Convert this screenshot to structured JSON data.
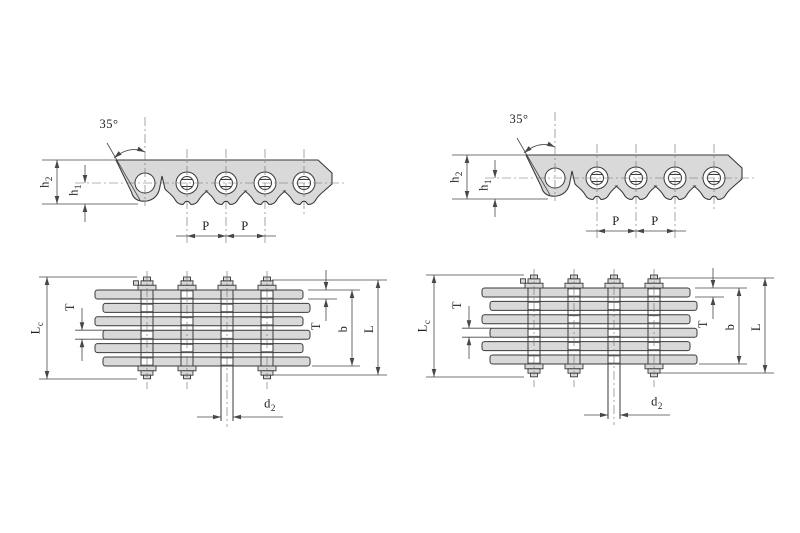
{
  "figure": {
    "type": "technical-drawing",
    "subject": "Leaf chain dimensional diagrams: two chain variants, each with a side elevation view and a stacked-plate plan view",
    "colors": {
      "background": "#ffffff",
      "line": "#3a3a3a",
      "dim_line": "#474747",
      "centerline": "#6a6a6a",
      "fill": "#d9d9d9",
      "text": "#222222"
    },
    "drawings": {
      "side_view": {
        "angle": "35°",
        "h2_base": "h",
        "h2_sub": "2",
        "h1_base": "h",
        "h1_sub": "1",
        "pitch": "P"
      },
      "plan_view": {
        "lc_base": "L",
        "lc_sub": "c",
        "t": "T",
        "b": "b",
        "l": "L",
        "d2_base": "d",
        "d2_sub": "2"
      }
    }
  }
}
